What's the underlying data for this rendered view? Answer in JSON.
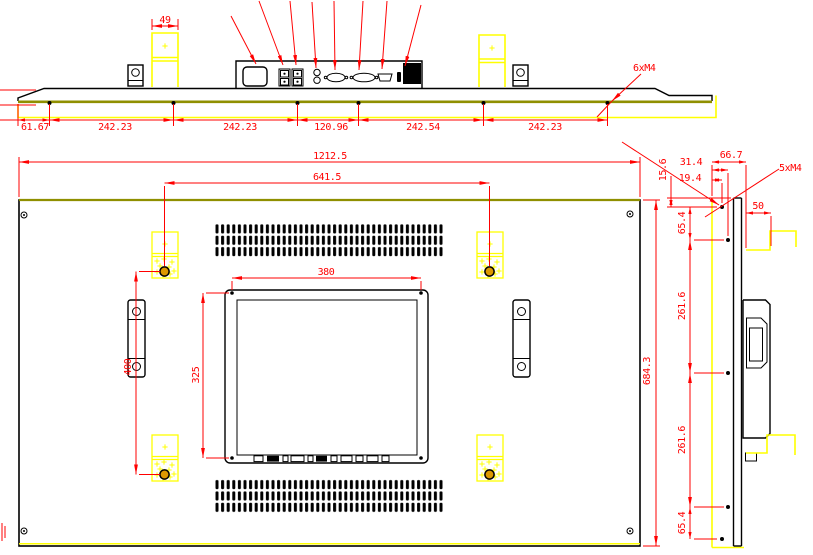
{
  "colors": {
    "dimension_red": "#ff0000",
    "highlight_yellow": "#ffff00",
    "edge_olive": "#8f8f00",
    "line_black": "#000000",
    "hole_fill_orange": "#dd9900"
  },
  "top_view": {
    "bracket_width_dim": "49",
    "thread_callout": "6xM4",
    "hole_chain_dims": [
      "61.67",
      "242.23",
      "242.23",
      "120.96",
      "242.54",
      "242.23"
    ]
  },
  "front_view": {
    "overall_width_dim": "1212.5",
    "mount_span_width_dim": "641.5",
    "opening_width_dim": "380",
    "opening_height_dim": "325",
    "mount_span_height_dim": "400",
    "overall_height_dim": "684.3"
  },
  "side_view": {
    "thread_callout": "5xM4",
    "top_depth_dim": "66.7",
    "hole_col_outer_dim": "31.4",
    "hole_col_inner_dim": "19.4",
    "top_edge_offset_dim": "15.6",
    "bracket_depth_dim": "50",
    "hole_row_dims": [
      "65.4",
      "261.6",
      "261.6",
      "65.4"
    ]
  }
}
